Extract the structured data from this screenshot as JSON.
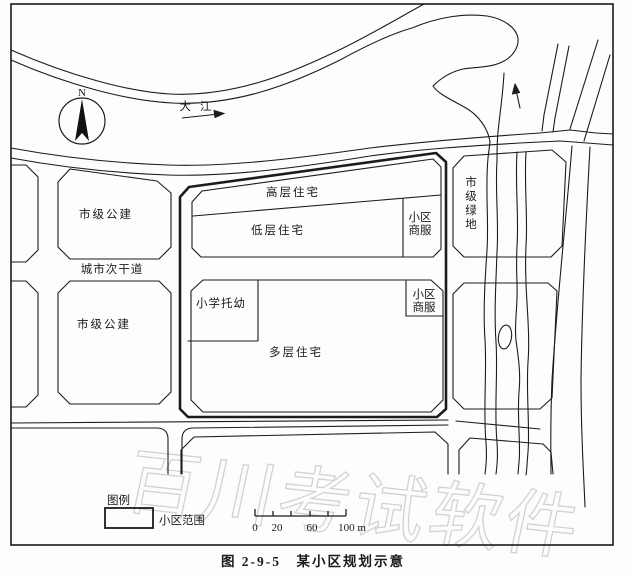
{
  "compass": {
    "north_label": "N"
  },
  "river": {
    "name": "大江"
  },
  "zones": {
    "city_public_upper": "市级公建",
    "city_public_lower": "市级公建",
    "highrise": "高层住宅",
    "lowrise": "低层住宅",
    "district_commercial_upper": [
      "小区",
      "商服"
    ],
    "district_commercial_lower": [
      "小区",
      "商服"
    ],
    "school_kindergarten": "小学托幼",
    "midrise": "多层住宅",
    "city_green_chars": [
      "市",
      "级",
      "绿",
      "地"
    ]
  },
  "roads": {
    "secondary_trunk": "城市次干道"
  },
  "legend": {
    "title": "图例",
    "district_boundary": "小区范围"
  },
  "scale_bar": {
    "labels": [
      "0",
      "20",
      "60",
      "100 m"
    ]
  },
  "caption": "图 2-9-5　某小区规划示意",
  "watermark": "百川考试软件"
}
